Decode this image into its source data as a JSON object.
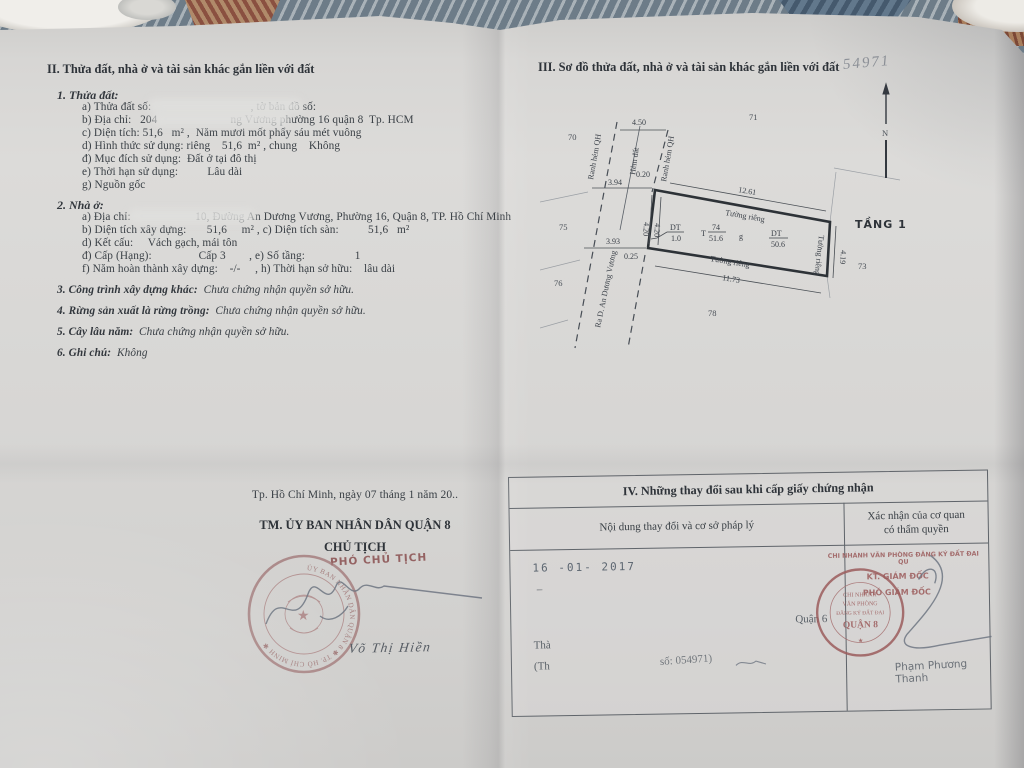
{
  "colors": {
    "paper": "#d7d6d4",
    "ink": "#3a4046",
    "stamp_red": "#9c5c5c",
    "seal_red": "#a37a7a",
    "signature": "#6e7682",
    "date_stamp": "#4f5a66"
  },
  "sec2": {
    "title": "II. Thửa đất, nhà ở và tài sản khác gắn liền với đất",
    "land": {
      "heading": "1. Thửa đất:",
      "lines": [
        "a) Thửa đất số:                                  , tờ bản đồ số:",
        "b) Địa chỉ:   204                         ng Vương phường 16 quận 8  Tp. HCM",
        "c) Diện tích: 51,6   m² ,  Năm mươi mốt phẩy sáu mét vuông",
        "d) Hình thức sử dụng: riêng    51,6  m² , chung    Không",
        "đ) Mục đích sử dụng:  Đất ở tại đô thị",
        "e) Thời hạn sử dụng:          Lâu dài",
        "g) Nguồn gốc"
      ]
    },
    "house": {
      "heading": "2. Nhà ở:",
      "lines": [
        "a) Địa chỉ:                      10, Đường An Dương Vương, Phường 16, Quận 8, TP. Hồ Chí Minh",
        "b) Diện tích xây dựng:       51,6     m² , c) Diện tích sàn:          51,6   m²",
        "d) Kết cấu:     Vách gạch, mái tôn",
        "đ) Cấp (Hạng):                Cấp 3        , e) Số tầng:                 1",
        "f) Năm hoàn thành xây dựng:    -/-     , h) Thời hạn sở hữu:    lâu dài"
      ]
    },
    "items": [
      {
        "label": "3. Công trình xây dựng khác:",
        "value": "  Chưa chứng nhận quyền sở hữu."
      },
      {
        "label": "4. Rừng sản xuất là rừng trồng:",
        "value": "  Chưa chứng nhận quyền sở hữu."
      },
      {
        "label": "5. Cây lâu năm:",
        "value": "  Chưa chứng nhận quyền sở hữu."
      },
      {
        "label": "6. Ghi chú:",
        "value": "  Không"
      }
    ]
  },
  "sec3": {
    "title": "III. Sơ đồ thửa đất, nhà ở và tài sản khác gắn liền với đất",
    "handwritten_number": "54971",
    "floor_label": "TẦNG 1",
    "diagram": {
      "parcels": {
        "n70": "70",
        "n71": "71",
        "n73": "73",
        "n75": "75",
        "n76": "76",
        "n78": "78"
      },
      "dims": {
        "alley_width": "4.50",
        "offset_top": "0.20",
        "front_top": "3.94",
        "side_left_outer": "4.20",
        "side_left_inner": "4.20",
        "front_bottom": "3.93",
        "offset_bottom": "0.25",
        "edge_top": "12.61",
        "edge_bottom": "11.73",
        "edge_right": "4.19"
      },
      "walls": {
        "top": "Tường riêng",
        "bottom": "Tường riêng",
        "right": "Tường riêng"
      },
      "inner": {
        "dt_left_label": "DT",
        "dt_left_value": "1.0",
        "t_prefix": "T",
        "plot_no": "74",
        "plot_area": "51.6",
        "g_label": "g",
        "dt_right_label": "DT",
        "dt_right_value": "50.6"
      },
      "roads": {
        "alley_left": "Ranh hẻm QH",
        "alley_mid": "Hẻm đất",
        "alley_right": "Ranh hẻm QH",
        "street": "Ra D. An Dương Vương"
      }
    }
  },
  "sign": {
    "date_line": "Tp. Hồ Chí Minh, ngày 07 tháng 1 năm 20..",
    "authority": "TM. ỦY BAN NHÂN DÂN QUẬN 8",
    "title": "CHỦ TỊCH",
    "stamp_overlay": "PHÓ CHỦ TỊCH",
    "signer_name": "Võ Thị Hiền",
    "seal_ring_text": "ỦY BAN NHÂN DÂN QUẬN 8 ✱ TP. HỒ CHÍ MINH ✱",
    "seal_star": "★"
  },
  "sec4": {
    "title": "IV. Những thay đổi sau khi cấp giấy chứng nhận",
    "col_left": "Nội dung thay đổi và cơ sở pháp lý",
    "col_right_1": "Xác nhận của cơ quan",
    "col_right_2": "có thẩm quyền",
    "left_cell": {
      "date_stamp": "16 -01- 2017",
      "dash": "–",
      "partial_1": "Thà",
      "partial_2": "(Th",
      "partial_number": "số: 054971)"
    },
    "right_cell": {
      "stamp_line1": "CHI NHÁNH VĂN PHÒNG ĐĂNG KÝ ĐẤT ĐAI QU",
      "stamp_line2": "KT. GIÁM ĐỐC",
      "stamp_line3": "PHÓ GIÁM ĐỐC",
      "seal_line1": "CHI NHÁNH",
      "seal_line2": "VĂN PHÒNG",
      "seal_line3": "ĐĂNG KÝ ĐẤT ĐAI",
      "seal_line4": "QUẬN 8",
      "seal_star": "★",
      "faint_text": "Quận 6",
      "signer_name": "Phạm Phương Thanh"
    }
  }
}
